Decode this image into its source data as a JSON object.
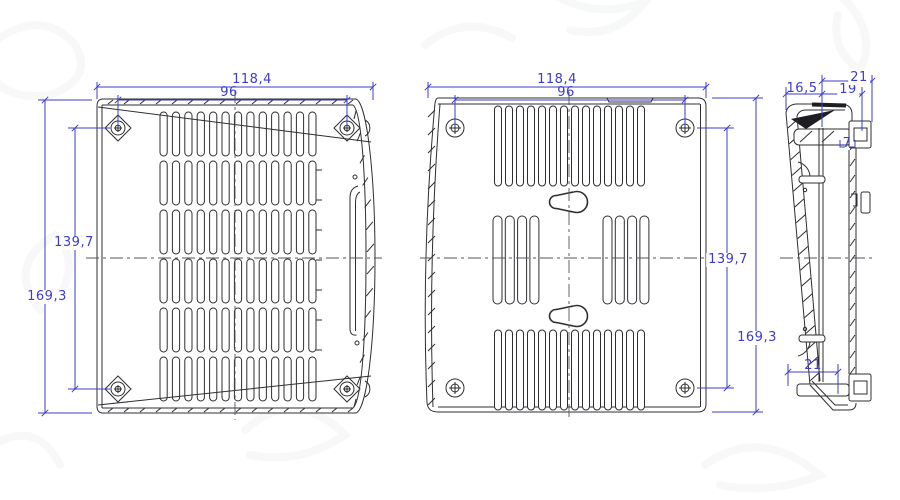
{
  "drawing": {
    "colors": {
      "line": "#2f2f33",
      "dimension": "#3c3ccf",
      "background": "#ffffff"
    },
    "front_view": {
      "width_outer": "118,4",
      "width_holes": "96",
      "height_holes": "139,7",
      "height_outer": "169,3"
    },
    "rear_view": {
      "width_outer": "118,4",
      "width_holes": "96",
      "height_holes": "139,7",
      "height_outer": "169,3"
    },
    "side_view": {
      "depth_face": "16,5",
      "depth_inner": "19",
      "depth_outer": "21",
      "clip_offset": "7",
      "base_width": "21"
    }
  }
}
